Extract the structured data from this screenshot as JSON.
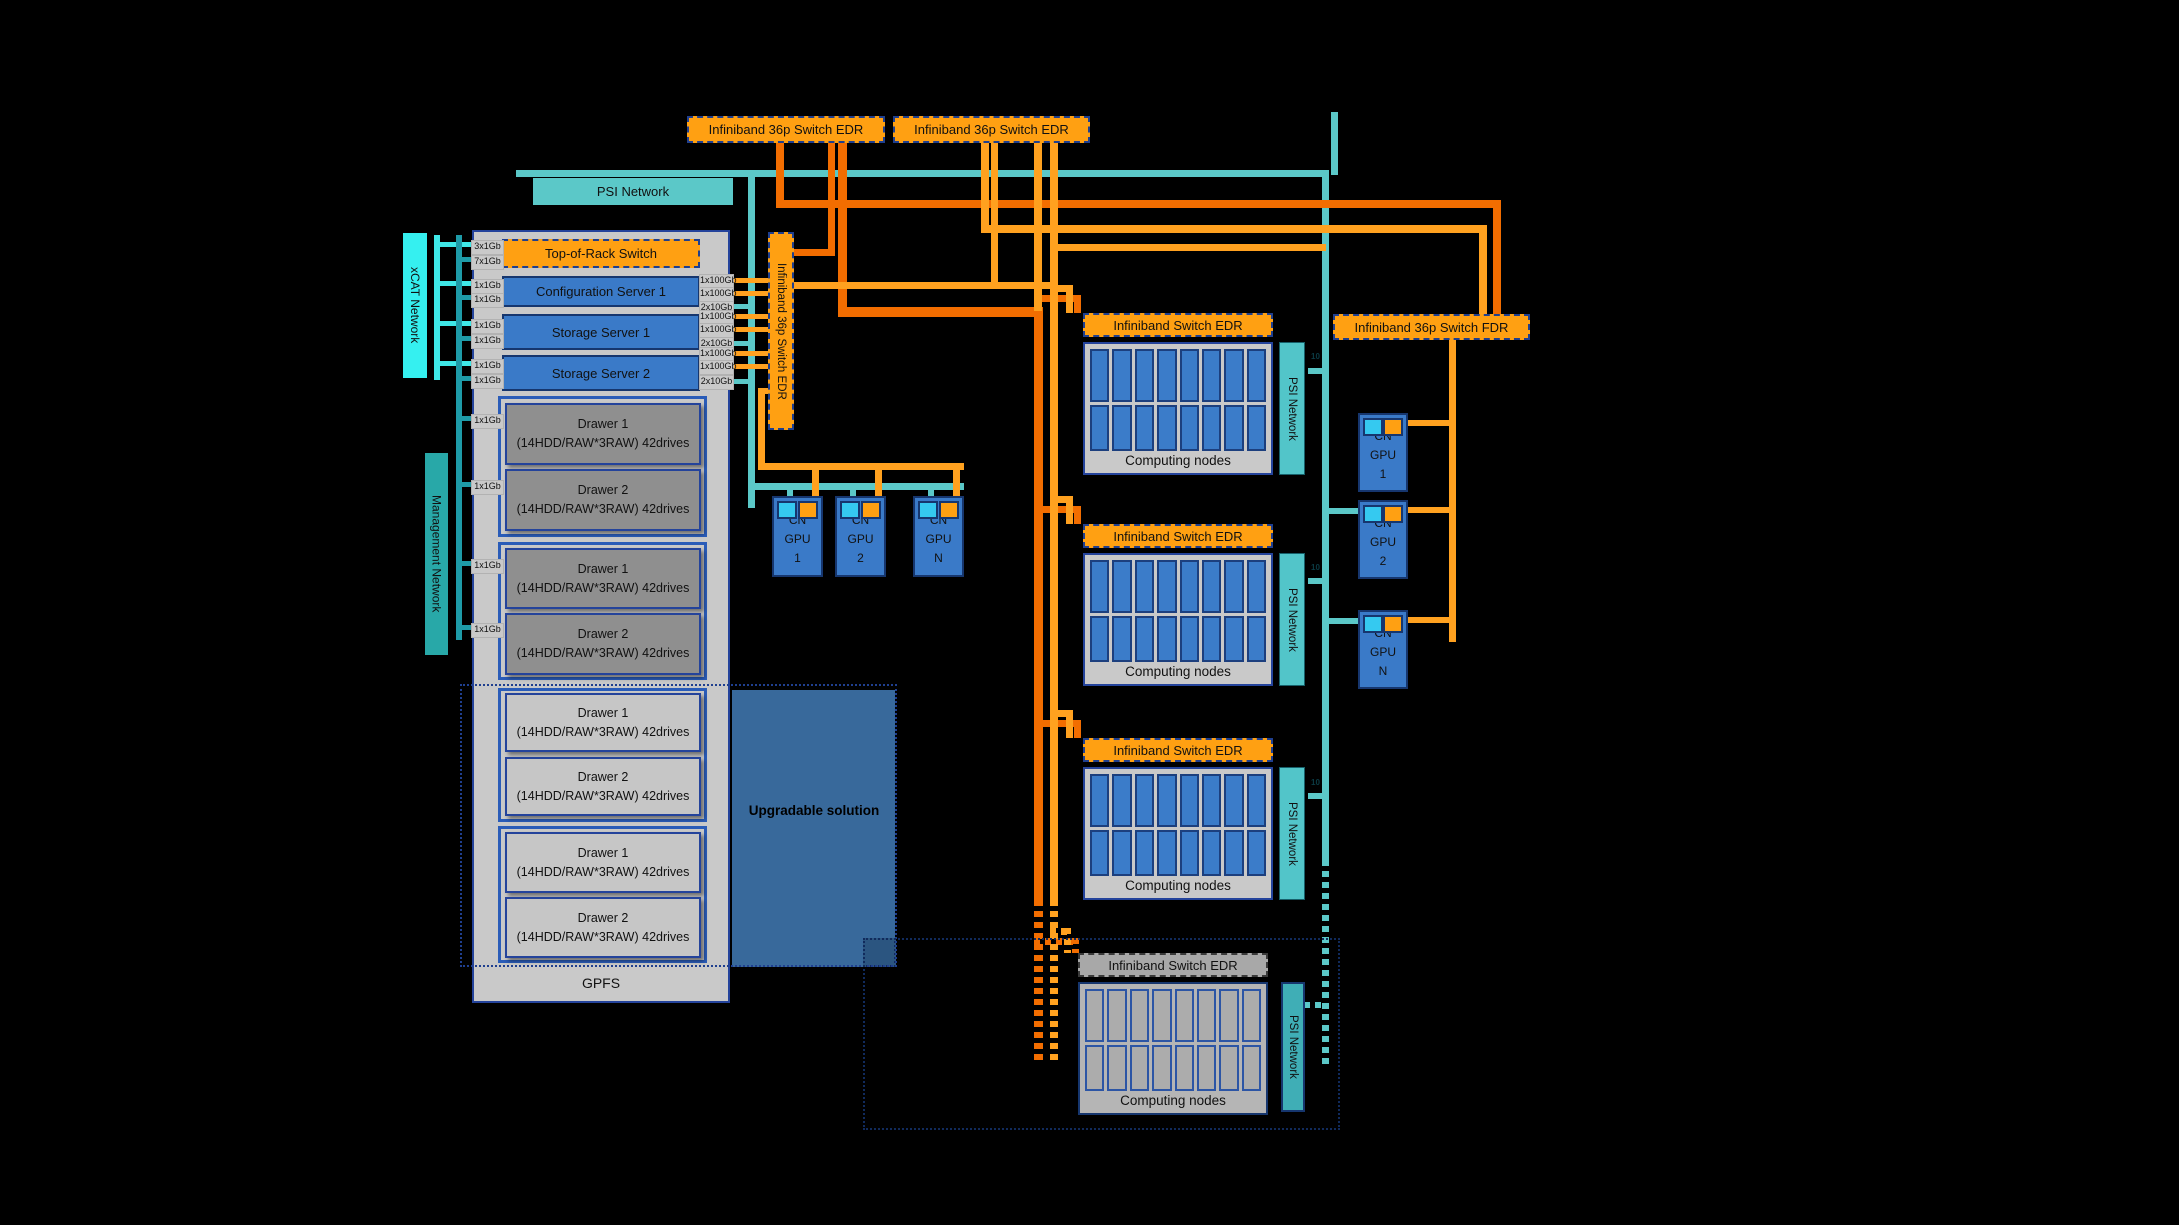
{
  "diagram": {
    "top_switches": [
      {
        "label": "Infiniband 36p Switch EDR"
      },
      {
        "label": "Infiniband 36p Switch EDR"
      }
    ],
    "psi_bus_label": "PSI Network",
    "xcat_label": "xCAT Network",
    "management_label": "Management Network",
    "vertical_switch_label": "Infiniband 36p Switch EDR",
    "fdr_switch_label": "Infiniband 36p Switch FDR",
    "rack": {
      "top_of_rack": "Top-of-Rack Switch",
      "servers": [
        "Configuration Server 1",
        "Storage Server 1",
        "Storage Server 2"
      ],
      "drawers": [
        {
          "title": "Drawer 1",
          "subtitle": "(14HDD/RAW*3RAW) 42drives",
          "state": "active"
        },
        {
          "title": "Drawer 2",
          "subtitle": "(14HDD/RAW*3RAW) 42drives",
          "state": "active"
        },
        {
          "title": "Drawer 1",
          "subtitle": "(14HDD/RAW*3RAW) 42drives",
          "state": "active"
        },
        {
          "title": "Drawer 2",
          "subtitle": "(14HDD/RAW*3RAW) 42drives",
          "state": "active"
        },
        {
          "title": "Drawer 1",
          "subtitle": "(14HDD/RAW*3RAW) 42drives",
          "state": "upgradable"
        },
        {
          "title": "Drawer 2",
          "subtitle": "(14HDD/RAW*3RAW) 42drives",
          "state": "upgradable"
        },
        {
          "title": "Drawer 1",
          "subtitle": "(14HDD/RAW*3RAW) 42drives",
          "state": "upgradable"
        },
        {
          "title": "Drawer 2",
          "subtitle": "(14HDD/RAW*3RAW) 42drives",
          "state": "upgradable"
        }
      ],
      "footer": "GPFS"
    },
    "left_ports": [
      "3x1Gb",
      "7x1Gb",
      "1x1Gb",
      "1x1Gb",
      "1x1Gb",
      "1x1Gb",
      "1x1Gb",
      "1x1Gb",
      "1x1Gb",
      "1x1Gb",
      "1x1Gb",
      "1x1Gb"
    ],
    "right_ports": [
      "1x100Gb",
      "1x100Gb",
      "2x10Gb",
      "1x100Gb",
      "1x100Gb",
      "2x10Gb",
      "1x100Gb",
      "1x100Gb",
      "2x10Gb"
    ],
    "psi_stub_label": "10",
    "gpu_mid": [
      {
        "lines": [
          "CN",
          "GPU",
          "1"
        ]
      },
      {
        "lines": [
          "CN",
          "GPU",
          "2"
        ]
      },
      {
        "lines": [
          "CN",
          "GPU",
          "N"
        ]
      }
    ],
    "gpu_right": [
      {
        "lines": [
          "CN",
          "GPU",
          "1"
        ]
      },
      {
        "lines": [
          "CN",
          "GPU",
          "2"
        ]
      },
      {
        "lines": [
          "CN",
          "GPU",
          "N"
        ]
      }
    ],
    "compute_blocks": [
      {
        "header": "Infiniband Switch EDR",
        "nodes_label": "Computing nodes",
        "psi_label": "PSI Network",
        "state": "active"
      },
      {
        "header": "Infiniband Switch EDR",
        "nodes_label": "Computing nodes",
        "psi_label": "PSI Network",
        "state": "active"
      },
      {
        "header": "Infiniband Switch EDR",
        "nodes_label": "Computing nodes",
        "psi_label": "PSI Network",
        "state": "active"
      },
      {
        "header": "Infiniband Switch EDR",
        "nodes_label": "Computing nodes",
        "psi_label": "PSI Network",
        "state": "upgradable"
      }
    ],
    "upgradable_labels": [
      "Upgradable solution",
      "Upgradable solution"
    ],
    "colors": {
      "orange_box": "#FFA012",
      "orange_line_dark": "#F26D00",
      "orange_line_light": "#FFA11F",
      "teal_line": "#5BC8C8",
      "teal_dark_line": "#1E9BA8",
      "cyan_line": "#3FE8E8",
      "xcat_cyan": "#35F0F0",
      "management_teal": "#28A8A8",
      "server_blue": "#3A7AC8",
      "navy_border": "#16366E",
      "steel_blue": "#38699B",
      "panel_gray": "#C9C9C9"
    }
  }
}
